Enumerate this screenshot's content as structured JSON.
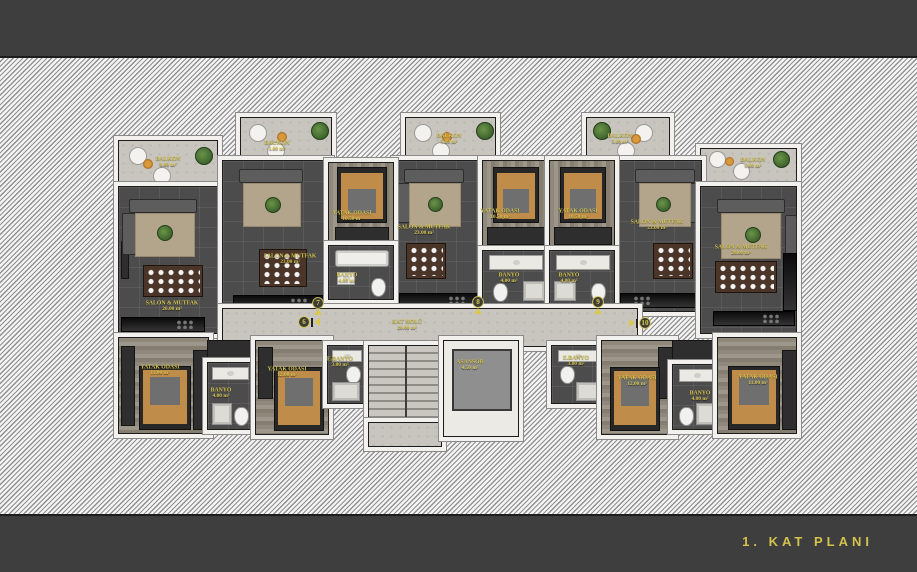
{
  "title": "1. KAT PLANI",
  "colors": {
    "label_yellow": "#d8c752",
    "band_dark": "#3e3e3e",
    "wall_white": "#f2f1ed",
    "floor_dark": "#4c4c4c",
    "floor_stone": "#c8c5be"
  },
  "markers": [
    "6",
    "7",
    "8",
    "9",
    "10"
  ],
  "rooms": {
    "balkon6": {
      "name": "BALKON",
      "area": "6.00 m²"
    },
    "balkon7": {
      "name": "BALKON",
      "area": "5.00 m²"
    },
    "balkon8": {
      "name": "BALKON",
      "area": "5.00 m²"
    },
    "balkon9": {
      "name": "BALKON",
      "area": "5.00 m²"
    },
    "balkon10": {
      "name": "BALKON",
      "area": "6.00 m²"
    },
    "salon6": {
      "name": "SALON & MUTFAK",
      "area": "26.00 m²"
    },
    "salon7": {
      "name": "SALON & MUTFAK",
      "area": "23.00 m²"
    },
    "salon8": {
      "name": "SALON & MUTFAK",
      "area": "23.00 m²"
    },
    "salon9": {
      "name": "SALON & MUTFAK",
      "area": "23.00 m²"
    },
    "salon10": {
      "name": "SALON & MUTFAK",
      "area": "26.00 m²"
    },
    "bed7": {
      "name": "YATAK ODASI",
      "area": "10.50 m²"
    },
    "bed8": {
      "name": "YATAK ODASI",
      "area": "10.50 m²"
    },
    "bed9": {
      "name": "YATAK ODASI",
      "area": "10.50 m²"
    },
    "banyo7": {
      "name": "BANYO",
      "area": "4.00 m²"
    },
    "banyo8": {
      "name": "BANYO",
      "area": "4.00 m²"
    },
    "banyo9": {
      "name": "BANYO",
      "area": "4.00 m²"
    },
    "bed6": {
      "name": "YATAK ODASI",
      "area": "11.00 m²"
    },
    "banyo6": {
      "name": "BANYO",
      "area": "4.00 m²"
    },
    "bed7b": {
      "name": "YATAK ODASI",
      "area": "12.00 m²"
    },
    "ebanyo7": {
      "name": "E.BANYO",
      "area": "3.00 m²"
    },
    "bed9b": {
      "name": "YATAK ODASI",
      "area": "12.00 m²"
    },
    "ebanyo9": {
      "name": "E.BANYO",
      "area": "3.00 m²"
    },
    "bed10": {
      "name": "YATAK ODASI",
      "area": "11.00 m²"
    },
    "banyo10": {
      "name": "BANYO",
      "area": "4.00 m²"
    },
    "hall": {
      "name": "KAT HOLÜ",
      "area": "20.00 m²"
    },
    "asansor": {
      "name": "ASANSÖR",
      "area": "4.50 m²"
    }
  }
}
